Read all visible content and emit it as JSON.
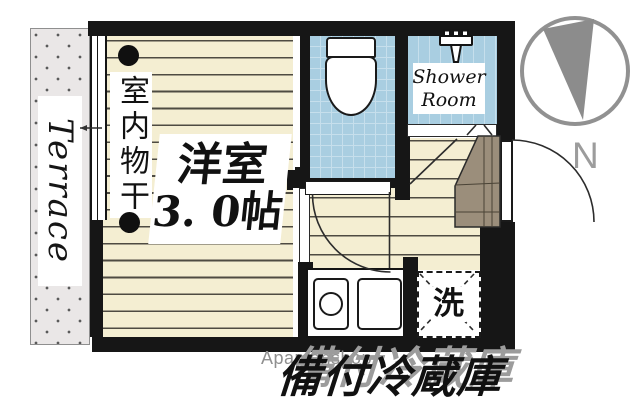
{
  "colors": {
    "wall": "#161616",
    "floor": "#f4eed2",
    "floor_line": "#4e4b42",
    "wet": "#a9cee1",
    "wet_line": "#c6dfec",
    "terrace_bg": "#eae7e7",
    "terrace_dot": "#5a5a5a",
    "cabinet": "#9b8e7b",
    "compass_gray": "#8c8c8c",
    "watermark_gray": "#8f8f8f",
    "caption_shadow": "#9c9c9c"
  },
  "labels": {
    "terrace": "Terrace",
    "indoor_drying": "室内物干",
    "room_name": "洋室",
    "room_size": "3. 0帖",
    "shower_line1": "Shower",
    "shower_line2": "Room",
    "washer": "洗",
    "compass_north": "N",
    "watermark": "Apamanshop",
    "caption": "備付冷蔵庫"
  }
}
